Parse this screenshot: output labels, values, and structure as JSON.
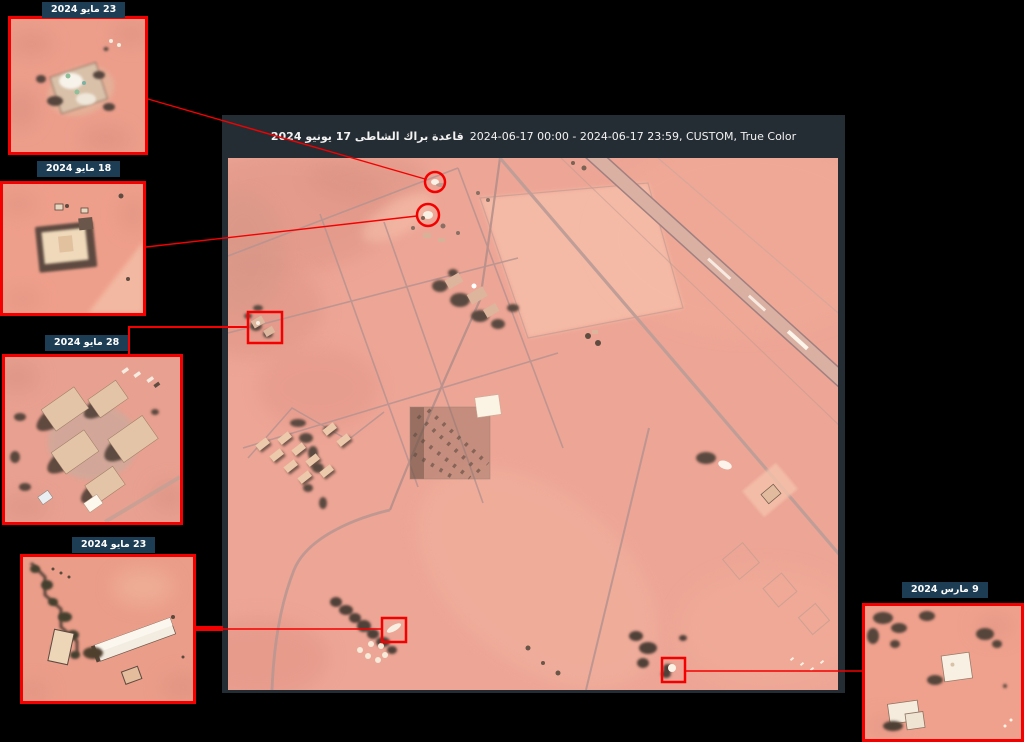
{
  "page": {
    "background": "#000000"
  },
  "main_panel": {
    "title_ar": "قاعدة براك الشاطى 17 يونيو 2024",
    "title_en": "2024-06-17 00:00 - 2024-06-17 23:59, CUSTOM, True Color"
  },
  "insets": [
    {
      "label": "23 مايو 2024",
      "position": "top-left"
    },
    {
      "label": "18 مايو 2024",
      "position": "left-upper"
    },
    {
      "label": "28 مايو 2024",
      "position": "left-middle"
    },
    {
      "label": "23 مايو 2024",
      "position": "left-lower"
    },
    {
      "label": "9 مارس 2024",
      "position": "bottom-right"
    }
  ],
  "colors": {
    "annotation_red": "#f40000",
    "label_bg": "#1d3d54",
    "label_text": "#ffffff",
    "panel_bg": "#252d34",
    "terrain_base": "#eda595"
  },
  "annotations": {
    "circle_markers": [
      {
        "cx": 435,
        "cy": 182,
        "r": 10
      },
      {
        "cx": 428,
        "cy": 215,
        "r": 11
      }
    ],
    "rect_markers": [
      {
        "x": 248,
        "y": 312,
        "w": 34,
        "h": 31
      },
      {
        "x": 382,
        "y": 618,
        "w": 24,
        "h": 24
      },
      {
        "x": 662,
        "y": 658,
        "w": 23,
        "h": 24
      }
    ]
  }
}
